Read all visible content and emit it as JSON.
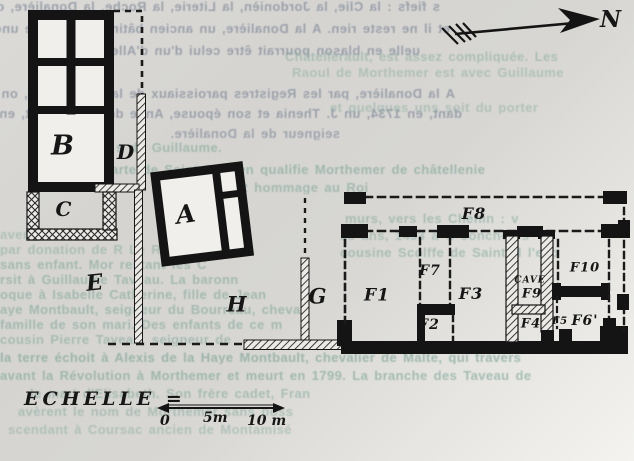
{
  "document": {
    "kind": "scanned hand-drawn site plan over faded printed text",
    "ink_color": "#161616",
    "paper_color": "#d7d6d2",
    "bleed_text_color": "#8e95a3",
    "recto_text_color": "#83a89d"
  },
  "north_arrow": {
    "label": "N"
  },
  "scale": {
    "label": "ECHELLE =",
    "ticks": [
      "0",
      "5m",
      "10 m"
    ]
  },
  "plan": {
    "room_labels": [
      {
        "id": "B",
        "text": "B",
        "x": 63,
        "y": 146,
        "size": 27
      },
      {
        "id": "D",
        "text": "D",
        "x": 126,
        "y": 152,
        "size": 20
      },
      {
        "id": "C",
        "text": "C",
        "x": 64,
        "y": 209,
        "size": 20
      },
      {
        "id": "A",
        "text": "A",
        "x": 186,
        "y": 214,
        "size": 25,
        "rot": -8
      },
      {
        "id": "E",
        "text": "E",
        "x": 95,
        "y": 283,
        "size": 22,
        "rot": -6
      },
      {
        "id": "H",
        "text": "H",
        "x": 237,
        "y": 304,
        "size": 21
      },
      {
        "id": "G",
        "text": "G",
        "x": 318,
        "y": 296,
        "size": 21
      },
      {
        "id": "F1",
        "text": "F1",
        "x": 377,
        "y": 296,
        "size": 17
      },
      {
        "id": "F7",
        "text": "F7",
        "x": 430,
        "y": 271,
        "size": 14
      },
      {
        "id": "F2",
        "text": "F2",
        "x": 429,
        "y": 325,
        "size": 14
      },
      {
        "id": "F3",
        "text": "F3",
        "x": 471,
        "y": 294,
        "size": 16
      },
      {
        "id": "F8",
        "text": "F8",
        "x": 474,
        "y": 214,
        "size": 16
      },
      {
        "id": "CAVE",
        "text": "CAVE",
        "x": 530,
        "y": 281,
        "size": 9
      },
      {
        "id": "F9",
        "text": "F9",
        "x": 532,
        "y": 294,
        "size": 13
      },
      {
        "id": "F4",
        "text": "F4",
        "x": 531,
        "y": 324,
        "size": 13
      },
      {
        "id": "F5",
        "text": "F5",
        "x": 560,
        "y": 322,
        "size": 10
      },
      {
        "id": "F10",
        "text": "F10",
        "x": 585,
        "y": 268,
        "size": 13
      },
      {
        "id": "F6",
        "text": "F6'",
        "x": 585,
        "y": 321,
        "size": 14
      }
    ]
  },
  "background_text": {
    "lines": [
      {
        "text": "s fiefs : la Clie, la Jordonièn, la Literie, la Roche, la Donalière, on n",
        "x": 0,
        "y": 0,
        "w": 440,
        "color": "gray",
        "mirrored": true,
        "op": 0.8
      },
      {
        "text": "et il ne reste rien. A la Donalière, un ancien bâtiment possède une cheminée",
        "x": 0,
        "y": 22,
        "w": 450,
        "color": "gray",
        "mirrored": true,
        "op": 0.8
      },
      {
        "text": "uelle en blason pourrait être celui d'un d'Allemagne.",
        "x": 0,
        "y": 44,
        "w": 420,
        "color": "gray",
        "mirrored": true,
        "op": 0.8
      },
      {
        "text": "Châtellerault, est assez compliquée. Les",
        "x": 285,
        "y": 50,
        "w": 349,
        "color": "teal",
        "op": 0.5
      },
      {
        "text": "Raoul de Morthemer est avec Guillaume",
        "x": 292,
        "y": 66,
        "w": 342,
        "color": "teal",
        "op": 0.45
      },
      {
        "text": "A la Donalière, par les Registres paroissiaux de la Chapelle-M., on trouv",
        "x": 0,
        "y": 87,
        "w": 455,
        "color": "gray",
        "mirrored": true,
        "op": 0.8
      },
      {
        "text": "dant, en 1734, un J. Thenia et son épouse, Anne de Connelle et, en 1868, Hubert",
        "x": 0,
        "y": 107,
        "w": 462,
        "color": "gray",
        "mirrored": true,
        "op": 0.8
      },
      {
        "text": "et quelques uns soit du porter",
        "x": 330,
        "y": 101,
        "w": 304,
        "color": "teal",
        "op": 0.45
      },
      {
        "text": "seigneur de la Donalière.",
        "x": 130,
        "y": 127,
        "w": 210,
        "color": "gray",
        "mirrored": true,
        "op": 0.75
      },
      {
        "text": "tras des s de Guillaume.",
        "x": 55,
        "y": 141,
        "w": 300,
        "color": "teal",
        "op": 0.6
      },
      {
        "text": "charte de Saint-Cyprien qualifie Morthemer de    châtellenie",
        "x": 95,
        "y": 163,
        "w": 539,
        "color": "teal",
        "op": 0.65
      },
      {
        "text": "ne rendait hommage au Roi",
        "x": 180,
        "y": 181,
        "w": 380,
        "color": "teal",
        "op": 0.6
      },
      {
        "text": "murs, vers     les Chenin : v",
        "x": 345,
        "y": 212,
        "w": 289,
        "color": "teal",
        "op": 0.55
      },
      {
        "text": "18 ans, 1493 à C       Jonchères",
        "x": 340,
        "y": 229,
        "w": 294,
        "color": "teal",
        "op": 0.5
      },
      {
        "text": "avent        été avec le",
        "x": 0,
        "y": 228,
        "w": 330,
        "color": "teal",
        "op": 0.45
      },
      {
        "text": "par donation de R     Le R     que lui",
        "x": 0,
        "y": 243,
        "w": 330,
        "color": "teal",
        "op": 0.5
      },
      {
        "text": "cousine Scolffe de Saint-M     l'esp",
        "x": 340,
        "y": 246,
        "w": 294,
        "color": "teal",
        "op": 0.55
      },
      {
        "text": "sans enfant. Mor         restant    les C",
        "x": 0,
        "y": 258,
        "w": 634,
        "color": "teal",
        "op": 0.6
      },
      {
        "text": "rsit à       Guillaume Taveau. La baronn",
        "x": 0,
        "y": 273,
        "w": 634,
        "color": "teal",
        "op": 0.6
      },
      {
        "text": "oque à Isabelle Catherine, fille de Jean",
        "x": 0,
        "y": 288,
        "w": 634,
        "color": "teal",
        "op": 0.6
      },
      {
        "text": "aye Montbault, seigneur du Bourreau, chevali",
        "x": 0,
        "y": 303,
        "w": 634,
        "color": "teal",
        "op": 0.6
      },
      {
        "text": "famille de son mari. Des enfants de ce m",
        "x": 0,
        "y": 318,
        "w": 634,
        "color": "teal",
        "op": 0.6
      },
      {
        "text": "cousin Pierre Taveau, seigneur de",
        "x": 0,
        "y": 333,
        "w": 520,
        "color": "teal",
        "op": 0.55
      },
      {
        "text": "la terre échoit à Alexis de la Haye Montbault, chevalier de Malte, qui travers",
        "x": 0,
        "y": 351,
        "w": 634,
        "color": "teal",
        "op": 0.7
      },
      {
        "text": "avant la Révolution à Morthemer et meurt en 1799. La branche des Taveau de",
        "x": 0,
        "y": 369,
        "w": 634,
        "color": "teal",
        "op": 0.65
      },
      {
        "text": "le mari d'Elisabeth. Son frère cadet, Fran",
        "x": 30,
        "y": 387,
        "w": 604,
        "color": "teal",
        "op": 0.55
      },
      {
        "text": "avèrent le nom de Morthemer sans poss",
        "x": 18,
        "y": 405,
        "w": 616,
        "color": "teal",
        "op": 0.5
      },
      {
        "text": "scendant à Coursac    ancien de Montamisé",
        "x": 8,
        "y": 423,
        "w": 626,
        "color": "teal",
        "op": 0.45
      }
    ]
  }
}
